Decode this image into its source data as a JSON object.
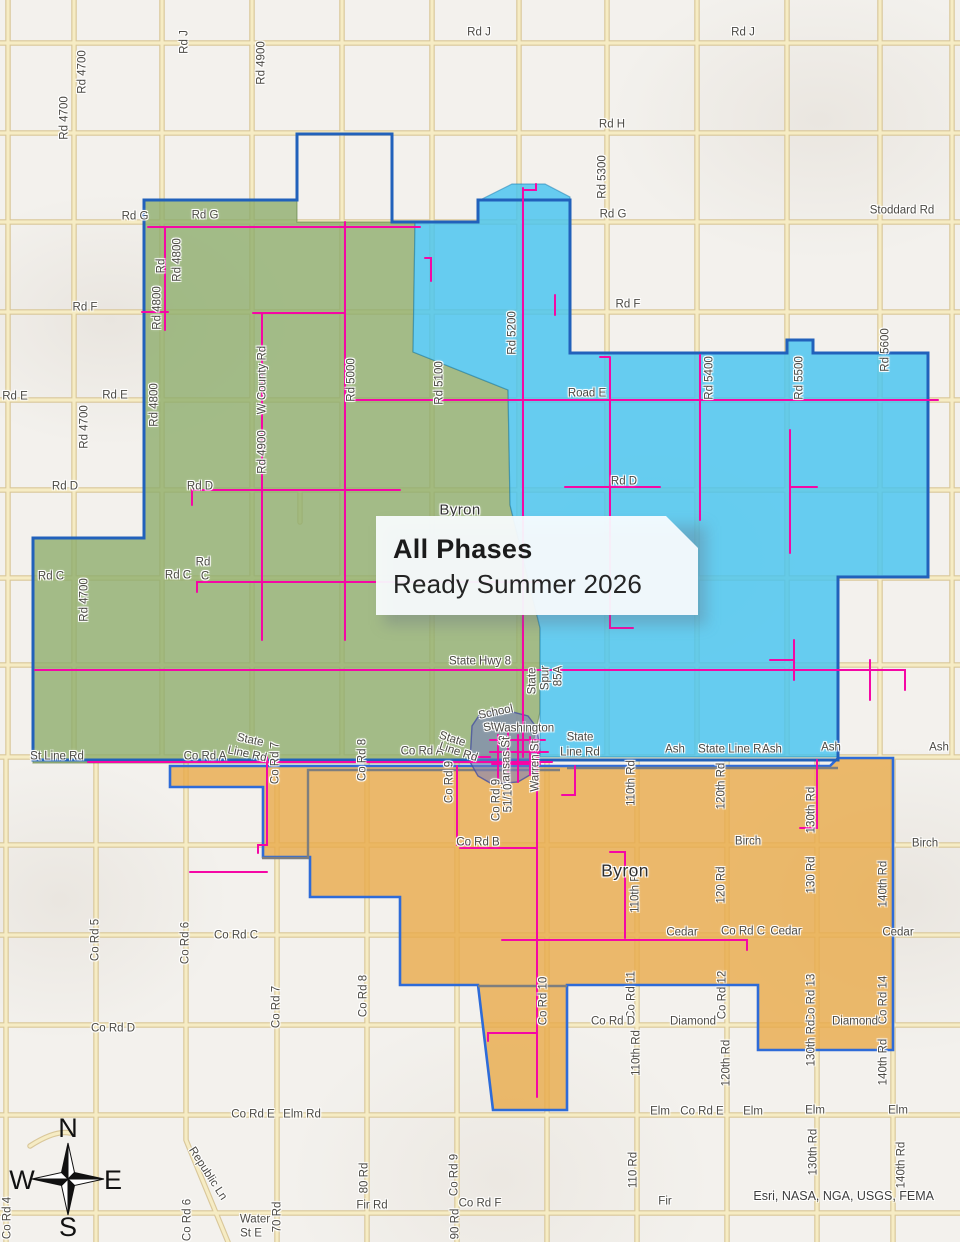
{
  "title_box": {
    "line1": "All Phases",
    "line2": "Ready Summer 2026"
  },
  "attribution": "Esri, NASA, NGA, USGS, FEMA",
  "compass": {
    "n": "N",
    "e": "E",
    "s": "S",
    "w": "W"
  },
  "colors": {
    "phase_green": "#8cac6a",
    "phase_blue": "#42c3f0",
    "phase_orange": "#e9aa4a",
    "boundary_blue": "#2161bb",
    "fiber_route_magenta": "#f507a5",
    "road_fill": "#f6ecc4",
    "road_casing": "#d9c79a",
    "townsite_purple": "#747bc0"
  },
  "places": [
    {
      "t": "Byron",
      "x": 460,
      "y": 510,
      "c": "place15"
    },
    {
      "t": "Byron",
      "x": 625,
      "y": 871,
      "c": "place17"
    }
  ],
  "map_labels": [
    {
      "t": "Rd J",
      "x": 185,
      "y": 42,
      "r": -90
    },
    {
      "t": "Rd J",
      "x": 743,
      "y": 33
    },
    {
      "t": "Rd J",
      "x": 479,
      "y": 33
    },
    {
      "t": "Rd 4700",
      "x": 83,
      "y": 72,
      "r": -90
    },
    {
      "t": "Rd 4700",
      "x": 65,
      "y": 118,
      "r": -90
    },
    {
      "t": "Rd 4900",
      "x": 262,
      "y": 63,
      "r": -90
    },
    {
      "t": "Rd H",
      "x": 612,
      "y": 125
    },
    {
      "t": "Rd G",
      "x": 135,
      "y": 217
    },
    {
      "t": "Rd G",
      "x": 205,
      "y": 216
    },
    {
      "t": "Rd G",
      "x": 613,
      "y": 215
    },
    {
      "t": "Stoddard Rd",
      "x": 902,
      "y": 211
    },
    {
      "t": "Rd",
      "x": 162,
      "y": 266,
      "r": -90
    },
    {
      "t": "Rd 4800",
      "x": 178,
      "y": 260,
      "r": -90
    },
    {
      "t": "Rd 4800",
      "x": 158,
      "y": 308,
      "r": -90
    },
    {
      "t": "Rd F",
      "x": 85,
      "y": 308
    },
    {
      "t": "Rd F",
      "x": 628,
      "y": 305
    },
    {
      "t": "Rd 5300",
      "x": 603,
      "y": 177,
      "r": -90
    },
    {
      "t": "Rd 5200",
      "x": 513,
      "y": 333,
      "r": -90
    },
    {
      "t": "Rd 5400",
      "x": 710,
      "y": 378,
      "r": -90
    },
    {
      "t": "Rd 5500",
      "x": 800,
      "y": 378,
      "r": -90
    },
    {
      "t": "Rd 5600",
      "x": 886,
      "y": 350,
      "r": -90
    },
    {
      "t": "Rd 4800",
      "x": 155,
      "y": 405,
      "r": -90
    },
    {
      "t": "Rd E",
      "x": 15,
      "y": 397
    },
    {
      "t": "Rd E",
      "x": 115,
      "y": 396
    },
    {
      "t": "Road E",
      "x": 587,
      "y": 394
    },
    {
      "t": "Rd 4700",
      "x": 85,
      "y": 427,
      "r": -90
    },
    {
      "t": "W County Rd",
      "x": 263,
      "y": 380,
      "r": -90
    },
    {
      "t": "Rd 4900",
      "x": 263,
      "y": 452,
      "r": -90
    },
    {
      "t": "Rd 5000",
      "x": 352,
      "y": 380,
      "r": -90
    },
    {
      "t": "Rd 5100",
      "x": 440,
      "y": 383,
      "r": -90
    },
    {
      "t": "Rd D",
      "x": 65,
      "y": 487
    },
    {
      "t": "Rd D",
      "x": 200,
      "y": 487
    },
    {
      "t": "Rd D",
      "x": 624,
      "y": 482
    },
    {
      "t": "Rd C",
      "x": 51,
      "y": 577
    },
    {
      "t": "Rd",
      "x": 203,
      "y": 563
    },
    {
      "t": "Rd C",
      "x": 178,
      "y": 576
    },
    {
      "t": "C",
      "x": 205,
      "y": 577
    },
    {
      "t": "Rd 4700",
      "x": 85,
      "y": 600,
      "r": -90
    },
    {
      "t": "State Hwy 8",
      "x": 480,
      "y": 662
    },
    {
      "t": "State",
      "x": 533,
      "y": 681,
      "r": -90
    },
    {
      "t": "Spur",
      "x": 546,
      "y": 678,
      "r": -90
    },
    {
      "t": "85A",
      "x": 559,
      "y": 676,
      "r": -90
    },
    {
      "t": "School",
      "x": 496,
      "y": 713,
      "r": -12
    },
    {
      "t": "St",
      "x": 489,
      "y": 728,
      "r": -12
    },
    {
      "t": "Washington",
      "x": 524,
      "y": 729
    },
    {
      "t": "St",
      "x": 503,
      "y": 742
    },
    {
      "t": "Kansas St",
      "x": 507,
      "y": 763,
      "r": -90
    },
    {
      "t": "Warren St",
      "x": 536,
      "y": 766,
      "r": -90
    },
    {
      "t": "St Line Rd",
      "x": 57,
      "y": 757
    },
    {
      "t": "Co Rd A",
      "x": 205,
      "y": 757
    },
    {
      "t": "State",
      "x": 250,
      "y": 741,
      "r": 12
    },
    {
      "t": "Line Rd",
      "x": 247,
      "y": 755,
      "r": 12
    },
    {
      "t": "Co Rd 7",
      "x": 276,
      "y": 763,
      "r": -90
    },
    {
      "t": "Co Rd 8",
      "x": 363,
      "y": 760,
      "r": -90
    },
    {
      "t": "Co Rd A",
      "x": 422,
      "y": 752
    },
    {
      "t": "State",
      "x": 452,
      "y": 740,
      "r": 18
    },
    {
      "t": "Line Rd",
      "x": 458,
      "y": 753,
      "r": 18
    },
    {
      "t": "Co Rd 9",
      "x": 450,
      "y": 782,
      "r": -90
    },
    {
      "t": "State",
      "x": 580,
      "y": 738
    },
    {
      "t": "Line Rd",
      "x": 580,
      "y": 753
    },
    {
      "t": "Ash",
      "x": 675,
      "y": 750
    },
    {
      "t": "State Line Rd",
      "x": 733,
      "y": 750
    },
    {
      "t": "Ash",
      "x": 772,
      "y": 750
    },
    {
      "t": "Ash",
      "x": 831,
      "y": 748
    },
    {
      "t": "Ash",
      "x": 939,
      "y": 748
    },
    {
      "t": "Co Rd 9",
      "x": 497,
      "y": 800,
      "r": -90
    },
    {
      "t": "51/10",
      "x": 509,
      "y": 798,
      "r": -90
    },
    {
      "t": "110th Rd",
      "x": 632,
      "y": 783,
      "r": -90
    },
    {
      "t": "120th Rd",
      "x": 722,
      "y": 786,
      "r": -90
    },
    {
      "t": "130th Rd",
      "x": 812,
      "y": 810,
      "r": -90
    },
    {
      "t": "Co Rd B",
      "x": 478,
      "y": 843
    },
    {
      "t": "Birch",
      "x": 748,
      "y": 842
    },
    {
      "t": "Birch",
      "x": 925,
      "y": 844
    },
    {
      "t": "110th Rd",
      "x": 636,
      "y": 890,
      "r": -90
    },
    {
      "t": "120 Rd",
      "x": 722,
      "y": 885,
      "r": -90
    },
    {
      "t": "130 Rd",
      "x": 812,
      "y": 875,
      "r": -90
    },
    {
      "t": "140th Rd",
      "x": 884,
      "y": 884,
      "r": -90
    },
    {
      "t": "Co Rd C",
      "x": 236,
      "y": 936
    },
    {
      "t": "Cedar",
      "x": 682,
      "y": 933
    },
    {
      "t": "Co Rd C",
      "x": 743,
      "y": 932
    },
    {
      "t": "Cedar",
      "x": 786,
      "y": 932
    },
    {
      "t": "Cedar",
      "x": 898,
      "y": 933
    },
    {
      "t": "Co Rd 5",
      "x": 96,
      "y": 940,
      "r": -90
    },
    {
      "t": "Co Rd 6",
      "x": 186,
      "y": 943,
      "r": -90
    },
    {
      "t": "Co Rd 7",
      "x": 277,
      "y": 1007,
      "r": -90
    },
    {
      "t": "Co Rd 8",
      "x": 364,
      "y": 996,
      "r": -90
    },
    {
      "t": "Co Rd 10",
      "x": 544,
      "y": 1001,
      "r": -90
    },
    {
      "t": "Co Rd 11",
      "x": 632,
      "y": 995,
      "r": -90
    },
    {
      "t": "Co Rd 12",
      "x": 723,
      "y": 995,
      "r": -90
    },
    {
      "t": "Co Rd 13",
      "x": 812,
      "y": 998,
      "r": -90
    },
    {
      "t": "Co Rd 14",
      "x": 884,
      "y": 1000,
      "r": -90
    },
    {
      "t": "Co Rd D",
      "x": 113,
      "y": 1029
    },
    {
      "t": "Co Rd D",
      "x": 613,
      "y": 1022
    },
    {
      "t": "Diamond",
      "x": 693,
      "y": 1022
    },
    {
      "t": "Diamond",
      "x": 855,
      "y": 1022
    },
    {
      "t": "110th Rd",
      "x": 637,
      "y": 1053,
      "r": -90
    },
    {
      "t": "120th Rd",
      "x": 727,
      "y": 1063,
      "r": -90
    },
    {
      "t": "130th Rd",
      "x": 812,
      "y": 1043,
      "r": -90
    },
    {
      "t": "140th Rd",
      "x": 884,
      "y": 1062,
      "r": -90
    },
    {
      "t": "Co Rd E",
      "x": 253,
      "y": 1115
    },
    {
      "t": "Elm Rd",
      "x": 302,
      "y": 1115
    },
    {
      "t": "Elm",
      "x": 660,
      "y": 1112
    },
    {
      "t": "Co Rd E",
      "x": 702,
      "y": 1112
    },
    {
      "t": "Elm",
      "x": 753,
      "y": 1112
    },
    {
      "t": "Elm",
      "x": 815,
      "y": 1111
    },
    {
      "t": "Elm",
      "x": 898,
      "y": 1111
    },
    {
      "t": "Republic Ln",
      "x": 207,
      "y": 1174,
      "r": 57
    },
    {
      "t": "Co Rd 6",
      "x": 188,
      "y": 1220,
      "r": -90
    },
    {
      "t": "Water",
      "x": 255,
      "y": 1220
    },
    {
      "t": "St E",
      "x": 251,
      "y": 1234
    },
    {
      "t": "70 Rd",
      "x": 278,
      "y": 1217,
      "r": -90
    },
    {
      "t": "80 Rd",
      "x": 365,
      "y": 1178,
      "r": -90
    },
    {
      "t": "Fir Rd",
      "x": 372,
      "y": 1206
    },
    {
      "t": "Fir",
      "x": 665,
      "y": 1202
    },
    {
      "t": "Co Rd F",
      "x": 480,
      "y": 1204
    },
    {
      "t": "Co Rd 9",
      "x": 455,
      "y": 1175,
      "r": -90
    },
    {
      "t": "90 Rd",
      "x": 456,
      "y": 1224,
      "r": -90
    },
    {
      "t": "Co Rd 4",
      "x": 8,
      "y": 1218,
      "r": -90
    },
    {
      "t": "110 Rd",
      "x": 634,
      "y": 1170,
      "r": -90
    },
    {
      "t": "130th Rd",
      "x": 814,
      "y": 1152,
      "r": -90
    },
    {
      "t": "140th Rd",
      "x": 902,
      "y": 1165,
      "r": -90
    }
  ]
}
